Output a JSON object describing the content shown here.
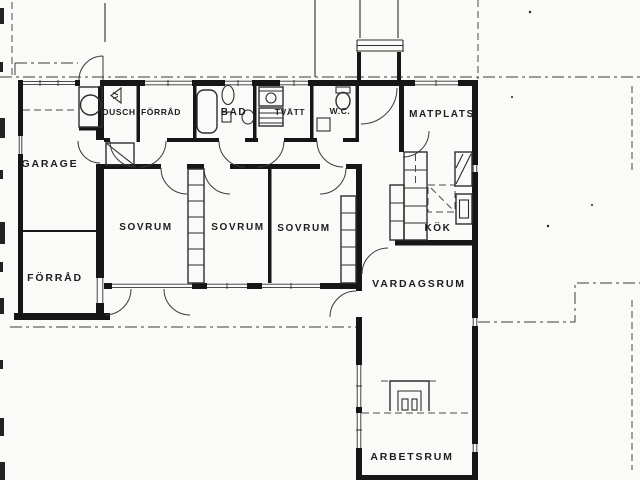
{
  "drawing": {
    "kind": "scanned architectural floor plan",
    "colors": {
      "paper": "#fafaf8",
      "ink": "#161616",
      "line": "#3a3a3a"
    }
  },
  "rooms": [
    {
      "id": "garage",
      "label": "GARAGE"
    },
    {
      "id": "forrad-garage",
      "label": "FÖRRÅD"
    },
    {
      "id": "dusch",
      "label": "DUSCH"
    },
    {
      "id": "forrad",
      "label": "FÖRRÅD"
    },
    {
      "id": "bad",
      "label": "BAD"
    },
    {
      "id": "tvatt",
      "label": "TVÄTT"
    },
    {
      "id": "wc",
      "label": "W.C."
    },
    {
      "id": "matplats",
      "label": "MATPLATS"
    },
    {
      "id": "kok",
      "label": "KÖK"
    },
    {
      "id": "sovrum-1",
      "label": "SOVRUM"
    },
    {
      "id": "sovrum-2",
      "label": "SOVRUM"
    },
    {
      "id": "sovrum-3",
      "label": "SOVRUM"
    },
    {
      "id": "vardagsrum",
      "label": "VARDAGSRUM"
    },
    {
      "id": "arbetsrum",
      "label": "ARBETSRUM"
    }
  ],
  "fixtures": [
    "boiler-circle-icon",
    "shower-icon",
    "bathtub-icon",
    "washbasin-icon",
    "toilet-icon",
    "washing-machine-icon",
    "laundry-bench-icon",
    "wc-toilet-icon",
    "wc-basin-icon",
    "hall-closet-icon",
    "wardrobe-column-icon",
    "kitchen-cabinets-icon",
    "refrigerator-icon",
    "stove-icon",
    "kitchen-island-icon",
    "fireplace-icon",
    "entrance-steps-icon"
  ]
}
